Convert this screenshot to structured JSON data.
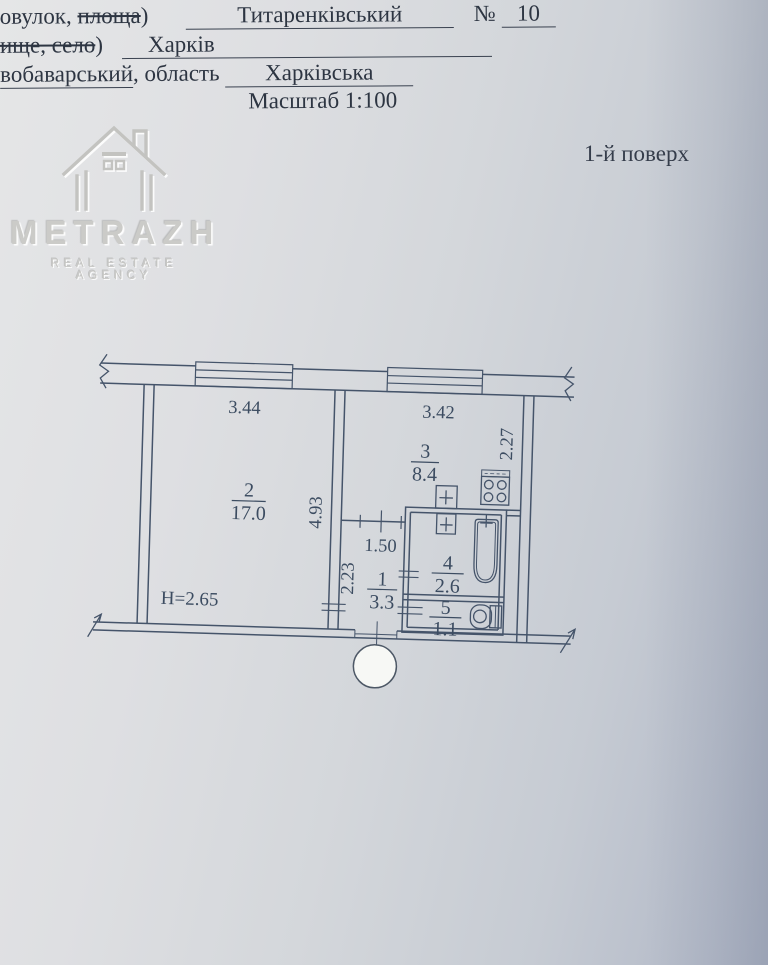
{
  "header": {
    "line1_label": "овулок, ",
    "line1_label_struck": "площа",
    "line1_paren": ")",
    "street_value": "Титаренківський",
    "number_sign": "№",
    "number_value": "10",
    "line2_label_struck": "ище, село",
    "line2_paren": ")",
    "city_value": "Харків",
    "district_value": "вобаварський",
    "line3_label": ", область",
    "region_value": "Харківська",
    "scale_label": "Масштаб 1:100"
  },
  "floor_label": "1-й поверх",
  "logo": {
    "name": "METRAZH",
    "subtitle": "REAL ESTATE AGENCY"
  },
  "plan": {
    "rooms": [
      {
        "num": "2",
        "area": "17.0"
      },
      {
        "num": "3",
        "area": "8.4"
      },
      {
        "num": "1",
        "area": "3.3"
      },
      {
        "num": "4",
        "area": "2.6"
      },
      {
        "num": "5",
        "area": "1.1"
      }
    ],
    "dims": {
      "window_left": "3.44",
      "window_right": "3.42",
      "kitchen_side": "2.27",
      "room2_side": "4.93",
      "hall_width": "1.50",
      "hall_side": "2.23",
      "ceiling_height": "H=2.65"
    }
  },
  "colors": {
    "ink": "#45546a",
    "paper": "#d7dade"
  }
}
